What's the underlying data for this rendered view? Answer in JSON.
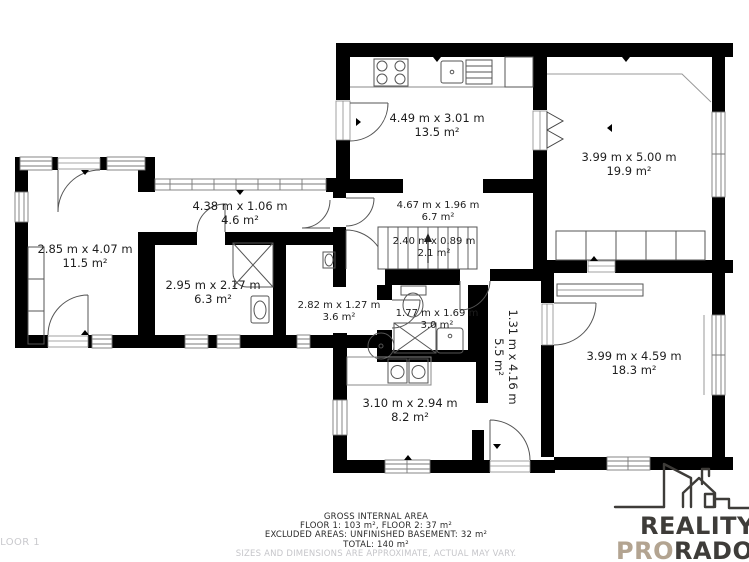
{
  "plan": {
    "floor_label": "FLOOR 1",
    "rooms": [
      {
        "id": "kitchen",
        "dims": "4.49 m x 3.01 m",
        "area": "13.5 m²"
      },
      {
        "id": "room-top-right",
        "dims": "3.99 m x 5.00 m",
        "area": "19.9 m²"
      },
      {
        "id": "hallway",
        "dims": "4.67 m x 1.96 m",
        "area": "6.7 m²"
      },
      {
        "id": "stairs",
        "dims": "2.40 m x 0.89 m",
        "area": "2.1 m²"
      },
      {
        "id": "room-left",
        "dims": "2.85 m x 4.07 m",
        "area": "11.5 m²"
      },
      {
        "id": "corridor-top",
        "dims": "4.38 m x 1.06 m",
        "area": "4.6 m²"
      },
      {
        "id": "bathroom",
        "dims": "2.95 m x 2.17 m",
        "area": "6.3 m²"
      },
      {
        "id": "hall-small",
        "dims": "2.82 m x 1.27 m",
        "area": "3.6 m²"
      },
      {
        "id": "wc",
        "dims": "1.77 m x 1.69 m",
        "area": "3.0 m²"
      },
      {
        "id": "corridor-vertical",
        "dims": "1.31 m x 4.16 m",
        "area": "5.5 m²"
      },
      {
        "id": "utility-room",
        "dims": "3.10 m x 2.94 m",
        "area": "8.2 m²"
      },
      {
        "id": "room-bottom-right",
        "dims": "3.99 m x 4.59 m",
        "area": "18.3 m²"
      }
    ]
  },
  "footer": {
    "title": "GROSS INTERNAL AREA",
    "line1": "FLOOR 1: 103 m², FLOOR 2: 37 m²",
    "line2": "EXCLUDED AREAS: UNFINISHED BASEMENT: 32 m²",
    "line3": "TOTAL: 140 m²",
    "disclaimer": "SIZES AND DIMENSIONS ARE APPROXIMATE, ACTUAL MAY VARY."
  },
  "logo": {
    "line1": "REALITY",
    "line2_accent": "PRO",
    "line2_rest": "RADOST",
    "accent_color": "#b3a491",
    "text_color": "#3e3c39"
  },
  "colors": {
    "wall": "#000000",
    "fixture_line": "#555555",
    "label_text": "#1e1e1e",
    "muted_text": "#c9c9cd"
  }
}
